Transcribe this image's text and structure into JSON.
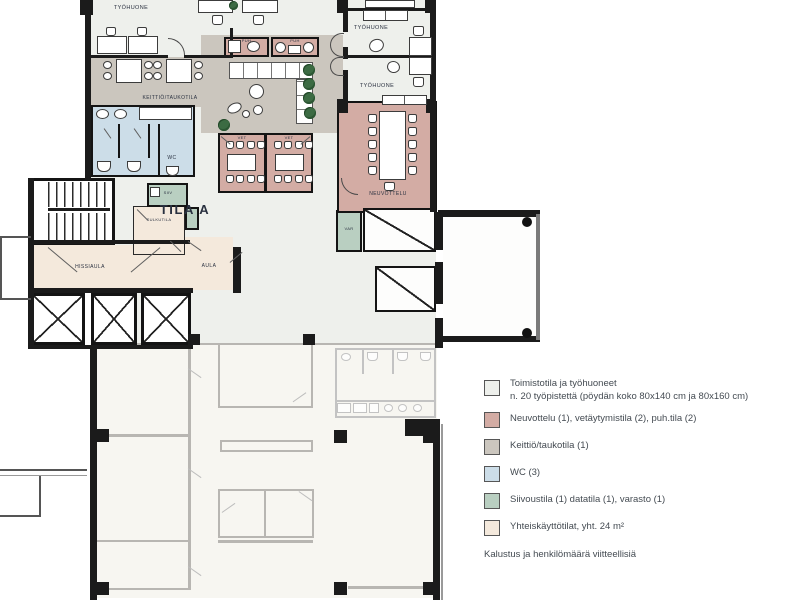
{
  "colors": {
    "office": "#eef0ec",
    "meeting": "#d3aca4",
    "kitchen": "#cbc6be",
    "wc": "#ccdde8",
    "service": "#b9cfc1",
    "common": "#f4e9dc",
    "outside": "#f7f6f1"
  },
  "labels": {
    "tyohuone": "TYÖHUONE",
    "keittio_taukotila": "KEITTIÖ/TAUKOTILA",
    "puh": "PUH",
    "vet": "VET",
    "tila_a": "TILA A",
    "neuvottelu": "NEUVOTTELU",
    "wc": "WC",
    "siiv": "SIIV",
    "sulkutila": "SULKUTILA",
    "hissiaula": "HISSIAULA",
    "aula": "AULA",
    "var": "VAR"
  },
  "legend": {
    "items": [
      {
        "fill": "office",
        "label": "Toimistotila ja työhuoneet",
        "label2": "n. 20 työpistettä (pöydän koko 80x140 cm ja 80x160 cm)"
      },
      {
        "fill": "meeting",
        "label": "Neuvottelu (1), vetäytymistila (2), puh.tila (2)"
      },
      {
        "fill": "kitchen",
        "label": "Keittiö/taukotila (1)"
      },
      {
        "fill": "wc",
        "label": "WC (3)"
      },
      {
        "fill": "service",
        "label": "Siivoustila (1) datatila (1), varasto (1)"
      },
      {
        "fill": "common",
        "label": "Yhteiskäyttötilat, yht. 24 m²"
      }
    ],
    "note": "Kalustus ja henkilömäärä viitteellisiä"
  }
}
